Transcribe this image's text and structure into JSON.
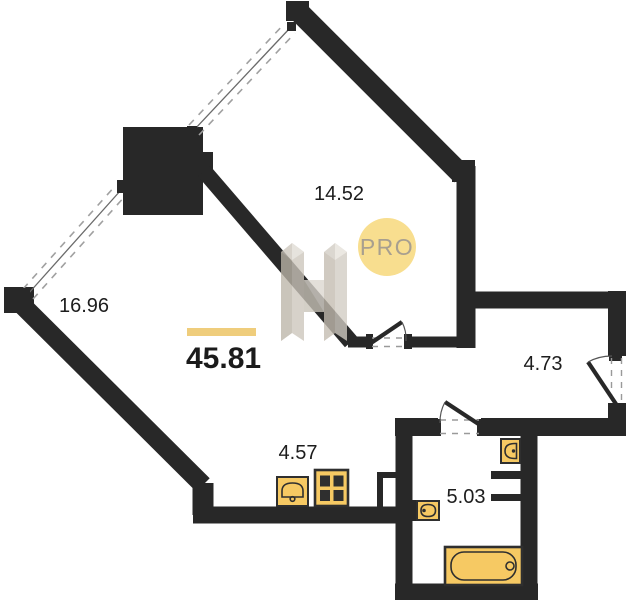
{
  "plan": {
    "total_area": {
      "value": "45.81"
    },
    "rooms": [
      {
        "name": "room-top",
        "area": "14.52"
      },
      {
        "name": "room-left",
        "area": "16.96"
      },
      {
        "name": "hallway",
        "area": "4.73"
      },
      {
        "name": "kitchen",
        "area": "4.57"
      },
      {
        "name": "bathroom",
        "area": "5.03"
      }
    ],
    "badge": {
      "label": "PRO"
    },
    "fixtures": [
      "bathtub-icon",
      "toilet-icon",
      "washbasin-icon",
      "kitchen-sink-icon",
      "stove-icon"
    ],
    "colors": {
      "wall": "#282828",
      "fixture": "#F6C963",
      "accent_bar": "#EFCD7C",
      "badge_bg": "#F8DE8F",
      "badge_text": "#A89F8F",
      "label": "#1D1D1D"
    }
  }
}
